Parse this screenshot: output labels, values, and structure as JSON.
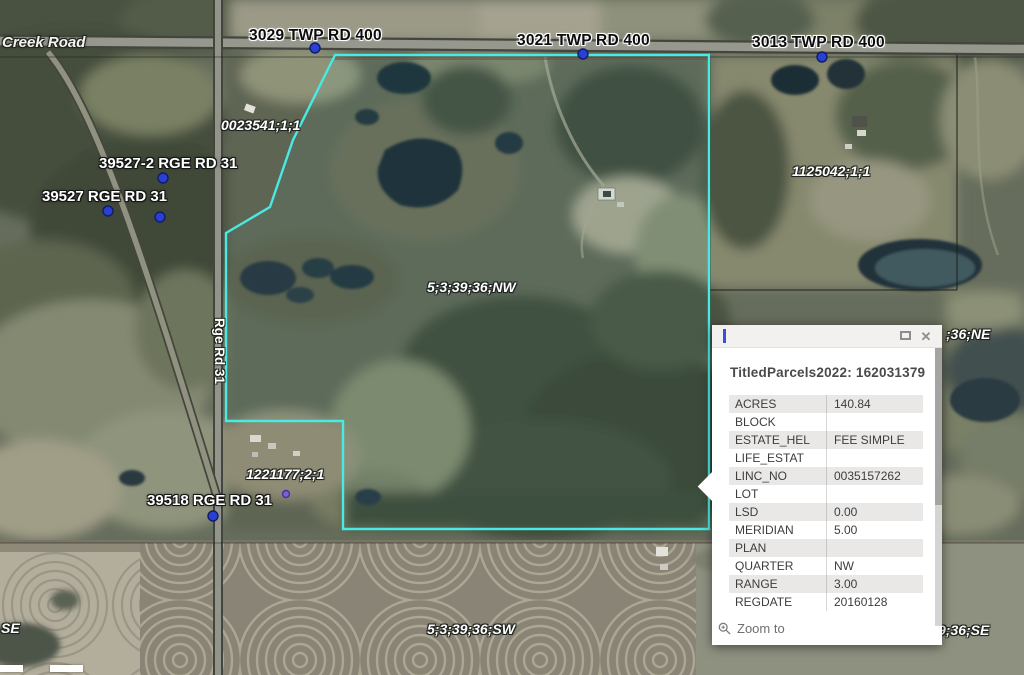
{
  "map": {
    "labels": [
      {
        "text": "Creek Road",
        "type": "road-name"
      },
      {
        "text": "3029 TWP RD 400",
        "type": "road-address"
      },
      {
        "text": "3021 TWP RD 400",
        "type": "road-address"
      },
      {
        "text": "3013 TWP RD 400",
        "type": "road-address"
      },
      {
        "text": "39527-2 RGE RD 31",
        "type": "site-address"
      },
      {
        "text": "39527 RGE RD 31",
        "type": "site-address"
      },
      {
        "text": "0023541;1;1",
        "type": "parcel-id"
      },
      {
        "text": "1125042;1;1",
        "type": "parcel-id"
      },
      {
        "text": "5;3;39;36;NW",
        "type": "quarter-section"
      },
      {
        "text": "Rge Rd 31",
        "type": "road-name-vertical"
      },
      {
        "text": "1221177;2;1",
        "type": "parcel-id"
      },
      {
        "text": "39518 RGE RD 31",
        "type": "site-address"
      },
      {
        "text": "5;3;39;36;SW",
        "type": "quarter-section"
      },
      {
        "text": ";36;NE",
        "type": "quarter-section-partial"
      },
      {
        "text": "9;36;SE",
        "type": "quarter-section-partial"
      },
      {
        "text": "SE",
        "type": "quarter-section-partial"
      }
    ],
    "colors": {
      "parcel_highlight": "#49e9e4",
      "address_point": "#2940d3",
      "road_fill": "#96988e"
    }
  },
  "popup": {
    "heading": "TitledParcels2022: 162031379",
    "rows": [
      {
        "field": "ACRES",
        "value": "140.84"
      },
      {
        "field": "BLOCK",
        "value": ""
      },
      {
        "field": "ESTATE_HEL",
        "value": "FEE SIMPLE"
      },
      {
        "field": "LIFE_ESTAT",
        "value": ""
      },
      {
        "field": "LINC_NO",
        "value": "0035157262"
      },
      {
        "field": "LOT",
        "value": ""
      },
      {
        "field": "LSD",
        "value": "0.00"
      },
      {
        "field": "MERIDIAN",
        "value": "5.00"
      },
      {
        "field": "PLAN",
        "value": ""
      },
      {
        "field": "QUARTER",
        "value": "NW"
      },
      {
        "field": "RANGE",
        "value": "3.00"
      },
      {
        "field": "REGDATE",
        "value": "20160128"
      }
    ],
    "zoom_to_label": "Zoom to",
    "icons": {
      "close": "✕",
      "maximize": "window-maximize",
      "zoom_to": "magnifier"
    }
  }
}
